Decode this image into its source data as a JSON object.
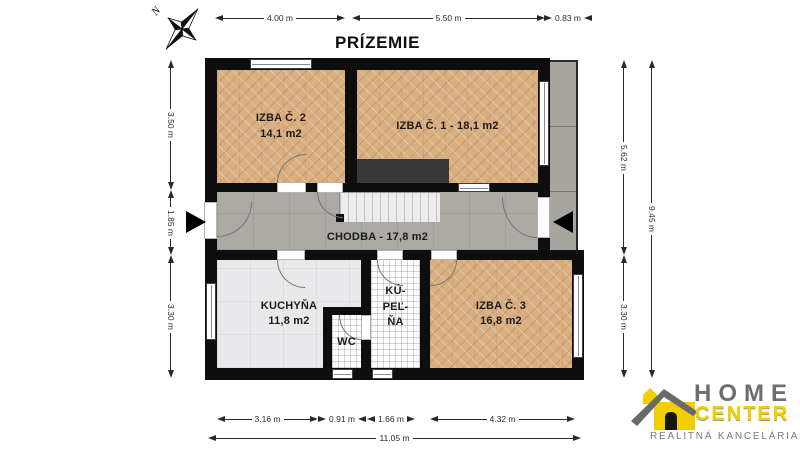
{
  "title": "PRÍZEMIE",
  "north_label": "N",
  "rooms": {
    "izba2": {
      "name": "IZBA Č. 2",
      "area": "14,1 m2"
    },
    "izba1": {
      "label": "IZBA Č. 1 - 18,1 m2"
    },
    "chodba": {
      "label": "CHODBA - 17,8 m2"
    },
    "kuchyna": {
      "name": "KUCHYŇA",
      "area": "11,8 m2"
    },
    "kupelna": {
      "lines": [
        "KÚ-",
        "PEĽ-",
        "ŇA"
      ]
    },
    "wc": {
      "name": "WC"
    },
    "izba3": {
      "name": "IZBA Č. 3",
      "area": "16,8 m2"
    }
  },
  "dims": {
    "top": [
      "4.00 m",
      "5.50 m",
      "0.83 m"
    ],
    "left": [
      "3.50 m",
      "1.85 m",
      "3.30 m"
    ],
    "right": [
      "5.62 m",
      "3.30 m"
    ],
    "right_total": "9.45 m",
    "bottom": [
      "3.16 m",
      "0.91 m",
      "1.66 m",
      "4.32 m"
    ],
    "bottom_total": "11.05 m"
  },
  "logo": {
    "home": "HOME",
    "center": "CENTER",
    "tagline": "REALITNÁ KANCELÁRIA"
  },
  "colors": {
    "parquet": "#d9ae80",
    "hallway": "#adaaa5",
    "kitchen": "#e9e9eb",
    "wall": "#0e0e0e",
    "logo_yellow": "#f2cd00",
    "logo_gray": "#6e6e6e"
  }
}
